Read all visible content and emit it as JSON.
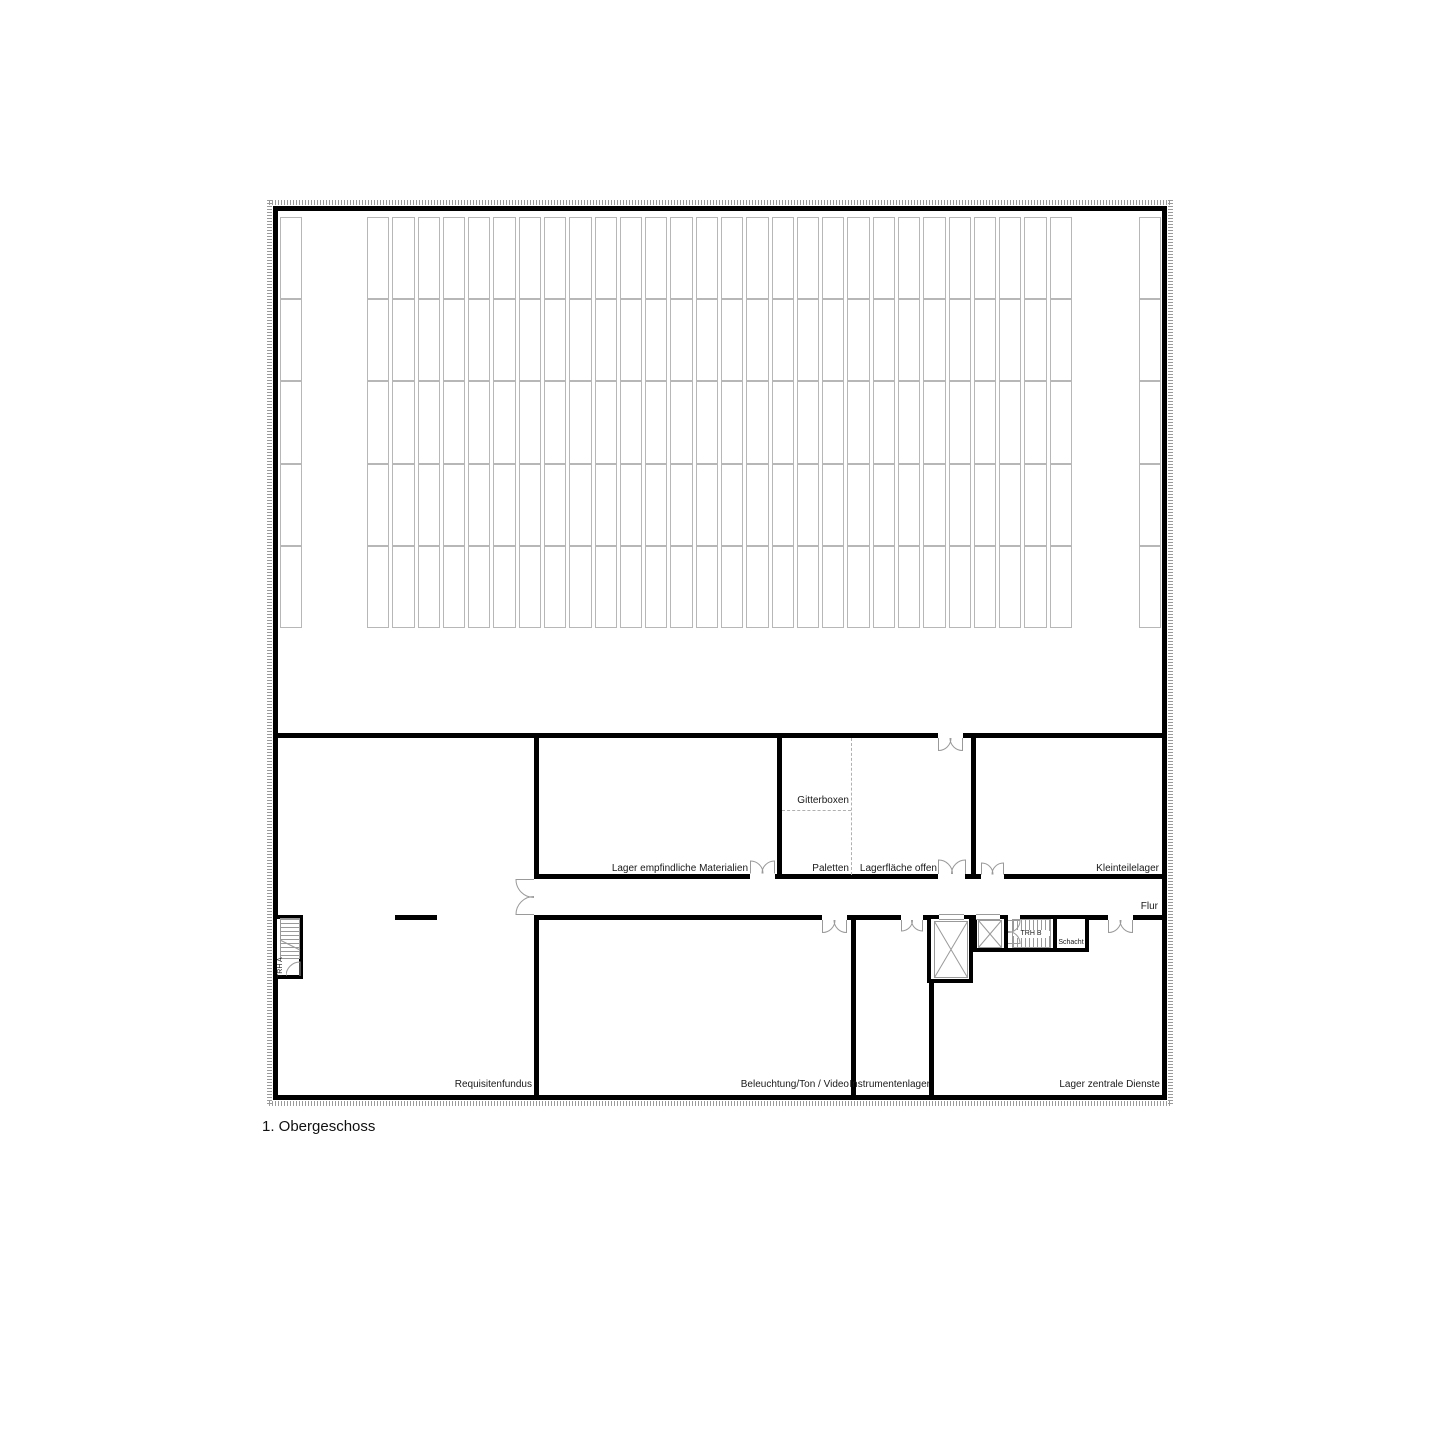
{
  "caption": "1. Obergeschoss",
  "colors": {
    "wall": "#000000",
    "rack_line": "#b7b7b7",
    "door_line": "#9a9a9a",
    "dashed_line": "#b0b0b0",
    "hatch": "#9a9a9a",
    "text": "#1a1a1a",
    "background": "#ffffff"
  },
  "racks": {
    "rows": 5,
    "main_columns": 28,
    "side_columns": 1
  },
  "rooms": {
    "requisitenfundus": {
      "label": "Requisitenfundus"
    },
    "lager_empfindliche_materialien": {
      "label": "Lager empfindliche Materialien"
    },
    "gitterboxen": {
      "label": "Gitterboxen"
    },
    "paletten": {
      "label": "Paletten"
    },
    "lagerflaeche_offen": {
      "label": "Lagerfläche offen"
    },
    "kleinteilelager": {
      "label": "Kleinteilelager"
    },
    "flur": {
      "label": "Flur"
    },
    "beleuchtung_ton_video": {
      "label": "Beleuchtung/Ton / Video"
    },
    "instrumentenlager": {
      "label": "Instrumentenlager"
    },
    "lager_zentrale_dienste": {
      "label": "Lager zentrale Dienste"
    },
    "treppenhaus_a": {
      "label": "TRH A"
    },
    "treppenhaus_b": {
      "label": "TRH B"
    },
    "schacht": {
      "label": "Schacht"
    }
  }
}
